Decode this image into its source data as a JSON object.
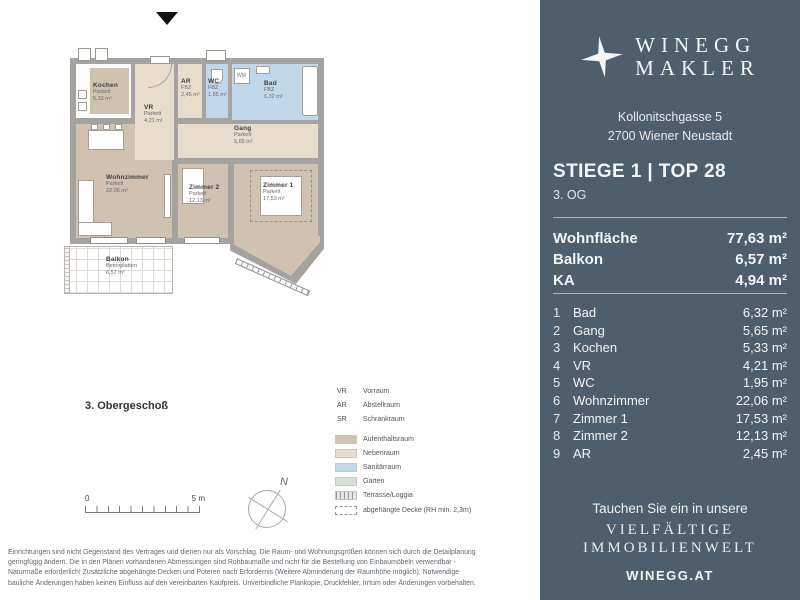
{
  "colors": {
    "sidebar_bg": "#4d5e6c",
    "wall_gray": "#a5a3a0",
    "aufenthaltsraum": "#cfc2b0",
    "nebenraum": "#e7ddca",
    "sanitaerraum": "#c0d8e9",
    "garten": "#d3e2d5"
  },
  "plan": {
    "floor_label": "3. Obergeschoß",
    "rooms": {
      "kochen": {
        "name": "Kochen",
        "floor": "Parkett",
        "area": "5,33 m²"
      },
      "vr": {
        "name": "VR",
        "floor": "Parkett",
        "area": "4,21 m²"
      },
      "ar": {
        "name": "AR",
        "floor": "FBZ",
        "area": "2,45 m²"
      },
      "wc": {
        "name": "WC",
        "floor": "FBZ",
        "area": "1,95 m²"
      },
      "bad": {
        "name": "Bad",
        "floor": "FBZ",
        "area": "6,32 m²"
      },
      "gang": {
        "name": "Gang",
        "floor": "Parkett",
        "area": "5,65 m²"
      },
      "wohnzimmer": {
        "name": "Wohnzimmer",
        "floor": "Parkett",
        "area": "22,06 m²"
      },
      "zimmer2": {
        "name": "Zimmer 2",
        "floor": "Parkett",
        "area": "12,13 m²"
      },
      "zimmer1": {
        "name": "Zimmer 1",
        "floor": "Parkett",
        "area": "17,53 m²"
      },
      "balkon": {
        "name": "Balkon",
        "floor": "Betonplatten",
        "area": "6,57 m²"
      }
    },
    "appliance_label_wm": "WM",
    "scale_start": "0",
    "scale_end": "5 m",
    "compass_label": "N"
  },
  "legend": {
    "abbreviations": [
      {
        "abbr": "VR",
        "label": "Vorraum"
      },
      {
        "abbr": "AR",
        "label": "Abstellraum"
      },
      {
        "abbr": "SR",
        "label": "Schrankraum"
      }
    ],
    "swatches": [
      {
        "label": "Aufenthaltsraum",
        "color": "#cfc2b0"
      },
      {
        "label": "Nebenraum",
        "color": "#e7ddca"
      },
      {
        "label": "Sanitärraum",
        "color": "#c0d8e9"
      },
      {
        "label": "Garten",
        "color": "#d3e2d5"
      },
      {
        "label": "Terrasse/Loggia",
        "pattern": "hatch"
      },
      {
        "label": "abgehängte Decke (RH min. 2,3m)",
        "pattern": "dashed"
      }
    ]
  },
  "sidebar": {
    "brand_line1": "WINEGG",
    "brand_line2": "MAKLER",
    "address_line1": "Kollonitschgasse 5",
    "address_line2": "2700 Wiener Neustadt",
    "unit_title": "STIEGE 1 | TOP 28",
    "unit_floor": "3. OG",
    "summary": [
      {
        "label": "Wohnfläche",
        "value": "77,63 m²"
      },
      {
        "label": "Balkon",
        "value": "6,57 m²"
      },
      {
        "label": "KA",
        "value": "4,94 m²"
      }
    ],
    "room_list": [
      {
        "num": "1",
        "name": "Bad",
        "value": "6,32 m²"
      },
      {
        "num": "2",
        "name": "Gang",
        "value": "5,65 m²"
      },
      {
        "num": "3",
        "name": "Kochen",
        "value": "5,33 m²"
      },
      {
        "num": "4",
        "name": "VR",
        "value": "4,21 m²"
      },
      {
        "num": "5",
        "name": "WC",
        "value": "1,95 m²"
      },
      {
        "num": "6",
        "name": "Wohnzimmer",
        "value": "22,06 m²"
      },
      {
        "num": "7",
        "name": "Zimmer 1",
        "value": "17,53 m²"
      },
      {
        "num": "8",
        "name": "Zimmer 2",
        "value": "12,13 m²"
      },
      {
        "num": "9",
        "name": "AR",
        "value": "2,45 m²"
      }
    ],
    "promo_line1": "Tauchen Sie ein in unsere",
    "promo_line2": "VIELFÄLTIGE",
    "promo_line3": "IMMOBILIENWELT",
    "website": "WINEGG.AT"
  },
  "footer": {
    "line1": "Einrichtungen sind nicht Gegenstand des Vertrages und dienen nur als Vorschlag. Die Raum- und Wohnungsgrößen können sich durch die Detailplanung",
    "line2": "geringfügig ändern. Die in den Plänen vorhandenen Abmessungen sind Rohbaumaße und nicht für die Bestellung von Einbaumöbeln verwendbar -",
    "line3": "Naturmaße erforderlich! Zusätzliche abgehängte Decken und Poteren nach Erfordernis (Weitere Abminderung der Raumhöhe möglich). Notwendige",
    "line4": "bauliche Änderungen haben keinen Einfluss auf den vereinbarten Kaufpreis. Unverbindliche Plankopie, Druckfehler, Irrtum oder Änderungen vorbehalten."
  }
}
